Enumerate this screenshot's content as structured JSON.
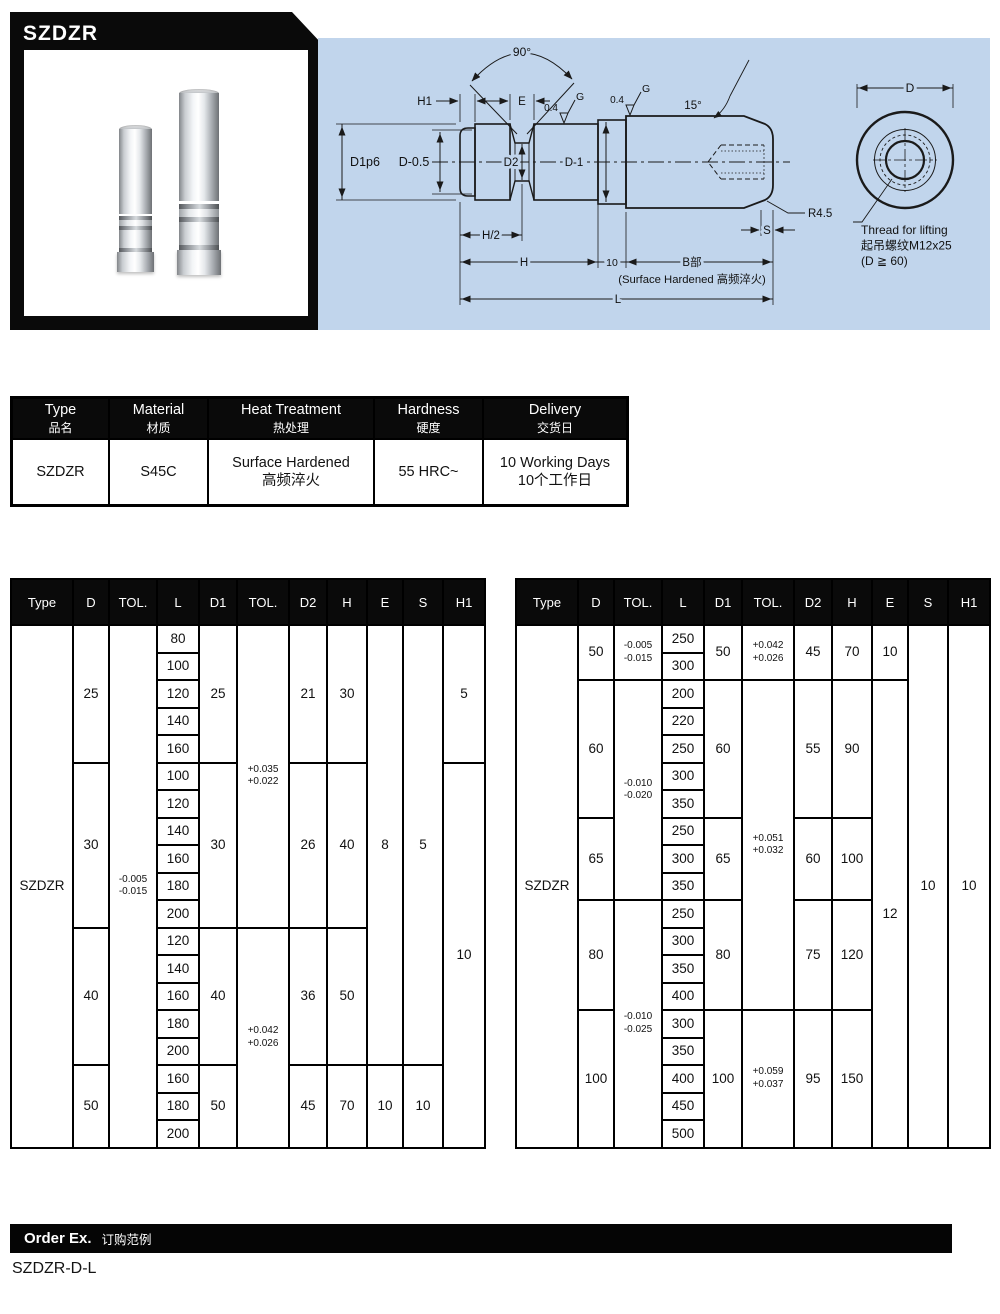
{
  "header": {
    "product_code": "SZDZR"
  },
  "drawing": {
    "labels": {
      "h1": "H1",
      "e": "E",
      "deg90": "90°",
      "finish1": "0.4",
      "finish1_g": "G",
      "finish2": "0.4",
      "finish2_g": "G",
      "deg15": "15°",
      "d1p6": "D1p6",
      "d_minus_05": "D-0.5",
      "d2": "D2",
      "d_minus_1": "D-1",
      "h_half": "H/2",
      "h": "H",
      "ten": "10",
      "b_part": "B部",
      "surface_note": "(Surface Hardened 高频淬火)",
      "l": "L",
      "r45": "R4.5",
      "s": "S",
      "d": "D",
      "thread_note_en": "Thread for lifting",
      "thread_note_zh": "起吊螺纹M12x25",
      "thread_note_cond": "(D ≧ 60)"
    }
  },
  "info_table": {
    "headers": [
      {
        "en": "Type",
        "zh": "品名"
      },
      {
        "en": "Material",
        "zh": "材质"
      },
      {
        "en": "Heat Treatment",
        "zh": "热处理"
      },
      {
        "en": "Hardness",
        "zh": "硬度"
      },
      {
        "en": "Delivery",
        "zh": "交货日"
      }
    ],
    "row": [
      "SZDZR",
      "S45C",
      "Surface Hardened\n高频淬火",
      "55 HRC~",
      "10 Working Days\n10个工作日"
    ]
  },
  "spec_tables": {
    "columns": [
      "Type",
      "D",
      "TOL.",
      "L",
      "D1",
      "TOL.",
      "D2",
      "H",
      "E",
      "S",
      "H1"
    ],
    "left": {
      "l_values": [
        "80",
        "100",
        "120",
        "140",
        "160",
        "100",
        "120",
        "140",
        "160",
        "180",
        "200",
        "120",
        "140",
        "160",
        "180",
        "200",
        "160",
        "180",
        "200"
      ],
      "cells": [
        [
          0,
          0,
          19,
          "SZDZR"
        ],
        [
          1,
          0,
          5,
          "25"
        ],
        [
          1,
          5,
          6,
          "30"
        ],
        [
          1,
          11,
          5,
          "40"
        ],
        [
          1,
          16,
          3,
          "50"
        ],
        [
          2,
          0,
          19,
          "-0.005\n-0.015",
          "sm"
        ],
        [
          4,
          0,
          5,
          "25"
        ],
        [
          4,
          5,
          6,
          "30"
        ],
        [
          4,
          11,
          5,
          "40"
        ],
        [
          4,
          16,
          3,
          "50"
        ],
        [
          5,
          0,
          11,
          "+0.035\n+0.022",
          "sm"
        ],
        [
          5,
          11,
          8,
          "+0.042\n+0.026",
          "sm"
        ],
        [
          6,
          0,
          5,
          "21"
        ],
        [
          6,
          5,
          6,
          "26"
        ],
        [
          6,
          11,
          5,
          "36"
        ],
        [
          6,
          16,
          3,
          "45"
        ],
        [
          7,
          0,
          5,
          "30"
        ],
        [
          7,
          5,
          6,
          "40"
        ],
        [
          7,
          11,
          5,
          "50"
        ],
        [
          7,
          16,
          3,
          "70"
        ],
        [
          8,
          0,
          16,
          "8"
        ],
        [
          8,
          16,
          3,
          "10"
        ],
        [
          9,
          0,
          16,
          "5"
        ],
        [
          9,
          16,
          3,
          "10"
        ],
        [
          10,
          0,
          5,
          "5"
        ],
        [
          10,
          5,
          14,
          "10"
        ]
      ]
    },
    "right": {
      "l_values": [
        "250",
        "300",
        "200",
        "220",
        "250",
        "300",
        "350",
        "250",
        "300",
        "350",
        "250",
        "300",
        "350",
        "400",
        "300",
        "350",
        "400",
        "450",
        "500"
      ],
      "cells": [
        [
          0,
          0,
          19,
          "SZDZR"
        ],
        [
          1,
          0,
          2,
          "50"
        ],
        [
          1,
          2,
          5,
          "60"
        ],
        [
          1,
          7,
          3,
          "65"
        ],
        [
          1,
          10,
          4,
          "80"
        ],
        [
          1,
          14,
          5,
          "100"
        ],
        [
          2,
          0,
          2,
          "-0.005\n-0.015",
          "sm"
        ],
        [
          2,
          2,
          8,
          "-0.010\n-0.020",
          "sm"
        ],
        [
          2,
          10,
          9,
          "-0.010\n-0.025",
          "sm"
        ],
        [
          4,
          0,
          2,
          "50"
        ],
        [
          4,
          2,
          5,
          "60"
        ],
        [
          4,
          7,
          3,
          "65"
        ],
        [
          4,
          10,
          4,
          "80"
        ],
        [
          4,
          14,
          5,
          "100"
        ],
        [
          5,
          0,
          2,
          "+0.042\n+0.026",
          "sm"
        ],
        [
          5,
          2,
          12,
          "+0.051\n+0.032",
          "sm"
        ],
        [
          5,
          14,
          5,
          "+0.059\n+0.037",
          "sm"
        ],
        [
          6,
          0,
          2,
          "45"
        ],
        [
          6,
          2,
          5,
          "55"
        ],
        [
          6,
          7,
          3,
          "60"
        ],
        [
          6,
          10,
          4,
          "75"
        ],
        [
          6,
          14,
          5,
          "95"
        ],
        [
          7,
          0,
          2,
          "70"
        ],
        [
          7,
          2,
          5,
          "90"
        ],
        [
          7,
          7,
          3,
          "100"
        ],
        [
          7,
          10,
          4,
          "120"
        ],
        [
          7,
          14,
          5,
          "150"
        ],
        [
          8,
          0,
          2,
          "10"
        ],
        [
          8,
          2,
          17,
          "12"
        ],
        [
          9,
          0,
          19,
          "10"
        ],
        [
          10,
          0,
          19,
          "10"
        ]
      ]
    }
  },
  "footer": {
    "order_label_en": "Order Ex.",
    "order_label_zh": "订购范例",
    "order_example": "SZDZR-D-L"
  }
}
